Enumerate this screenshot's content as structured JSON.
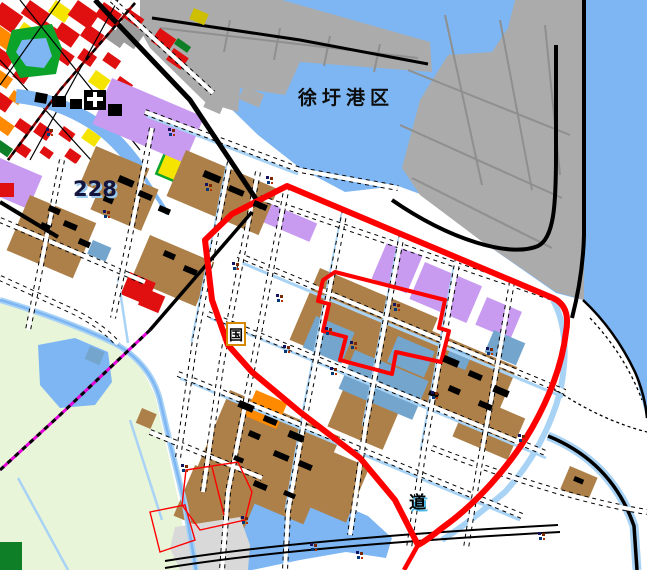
{
  "map": {
    "kind": "land-use planning map",
    "labels": {
      "port_area": "徐圩港区",
      "highway_number": "228",
      "road_partial": "道",
      "route_shield": "国"
    },
    "colors": {
      "sea": "#7db6f2",
      "canal": "#a9d3f5",
      "land": "#ffffff",
      "port": "#ababab",
      "portline": "#8f8f8f",
      "village": "#ad8049",
      "purple": "#c89bf0",
      "steel": "#74a5cd",
      "opengreen": "#e9f5d9",
      "park": "#0ca32a",
      "urbanred": "#e01010",
      "yellow": "#f5e400",
      "darkyellow": "#cdbf00",
      "orange": "#ff8a00",
      "gray": "#9c9c9c",
      "lightgray": "#d9d9d9",
      "darkgreen": "#0e7f26",
      "boundary": "#ff0000",
      "magenta": "#e500d8",
      "darkred": "#8b0000"
    },
    "tiny_label_markers": [
      [
        46,
        128
      ],
      [
        168,
        128
      ],
      [
        266,
        176
      ],
      [
        232,
        262
      ],
      [
        276,
        294
      ],
      [
        325,
        327
      ],
      [
        350,
        341
      ],
      [
        283,
        345
      ],
      [
        393,
        303
      ],
      [
        330,
        367
      ],
      [
        431,
        391
      ],
      [
        486,
        347
      ],
      [
        518,
        434
      ],
      [
        241,
        516
      ],
      [
        310,
        543
      ],
      [
        356,
        551
      ],
      [
        538,
        532
      ],
      [
        181,
        464
      ],
      [
        103,
        210
      ],
      [
        205,
        183
      ]
    ]
  }
}
